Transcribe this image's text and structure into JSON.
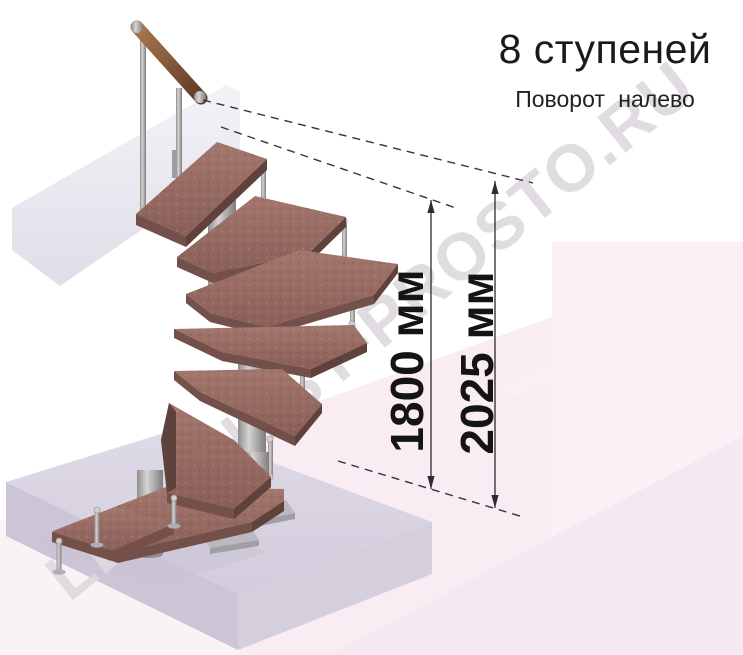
{
  "header": {
    "title": "8 ступеней",
    "subtitle": "Поворот налево"
  },
  "dimensions": [
    {
      "id": "flight-height",
      "label": "1800 мм",
      "value_mm": 1800
    },
    {
      "id": "overall-height",
      "label": "2025 мм",
      "value_mm": 2025
    }
  ],
  "watermark": "LESTNITSY-PROSTO.RU",
  "staircase": {
    "steps_count": 8,
    "turn_direction": "налево",
    "colors": {
      "wood_tread": "#96685e",
      "wood_edge": "#74504a",
      "handrail_wood": "#9a6a4a",
      "metal": "#b5b3b1",
      "floor_slab": "#d6d2de",
      "upper_slab": "#ebeaf0",
      "background_pink": "#f8ebf2",
      "dimension_line": "#2e2933",
      "text": "#1a1a1a",
      "watermark": "#e3dee2"
    }
  }
}
